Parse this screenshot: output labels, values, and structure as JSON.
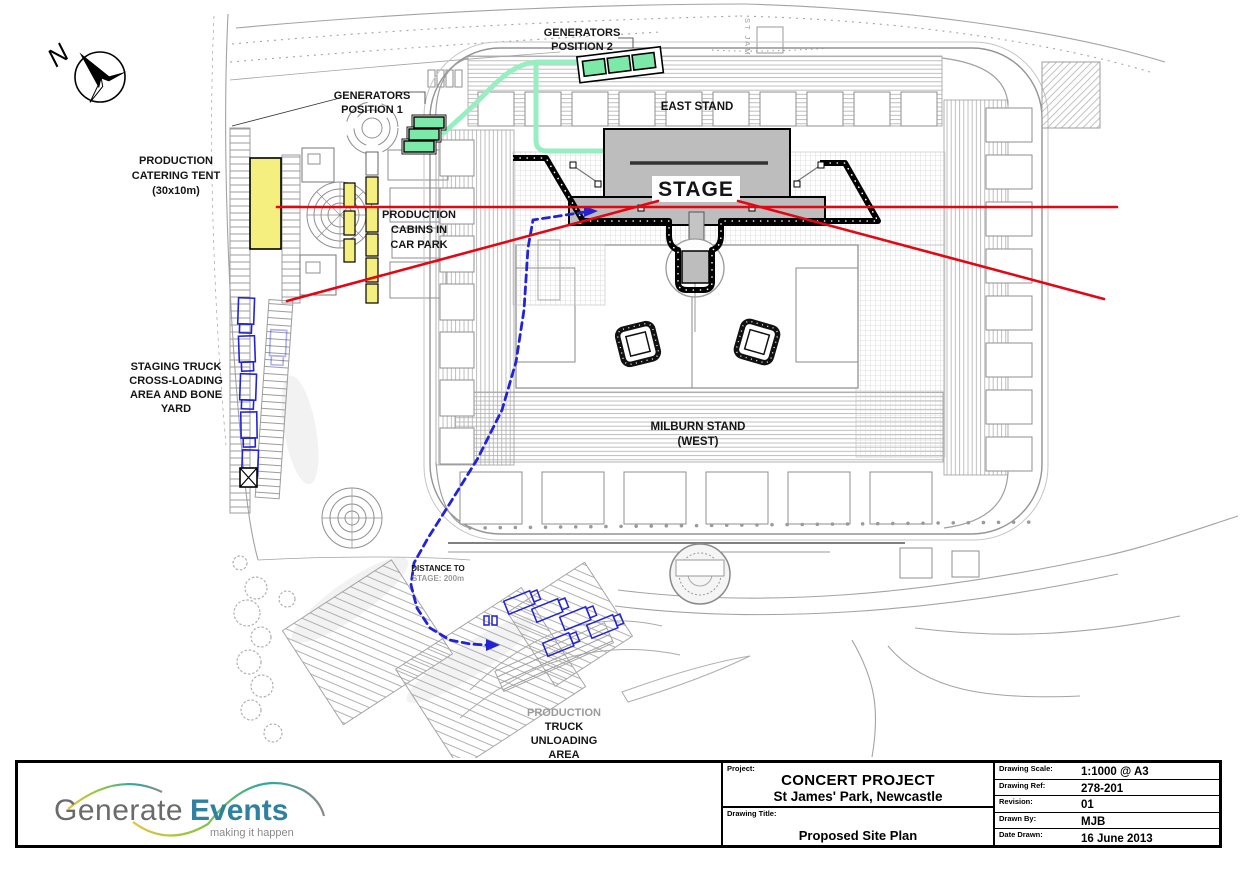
{
  "compass": {
    "north_label": "N"
  },
  "plan_labels": {
    "street_name": "ST JAM",
    "generators_position_2": [
      "GENERATORS",
      "POSITION 2"
    ],
    "generators_position_1": [
      "GENERATORS",
      "POSITION 1"
    ],
    "production_catering_tent": [
      "PRODUCTION",
      "CATERING TENT",
      "(30x10m)"
    ],
    "production_cabins": [
      "PRODUCTION",
      "CABINS IN",
      "CAR PARK"
    ],
    "east_stand": "EAST STAND",
    "stage": "STAGE",
    "milburn_stand": [
      "MILBURN STAND",
      "(WEST)"
    ],
    "staging_truck_yard": [
      "STAGING TRUCK",
      "CROSS-LOADING",
      "AREA AND BONE",
      "YARD"
    ],
    "distance_to_stage": [
      "DISTANCE TO",
      "STAGE: 200m"
    ],
    "production_truck_unloading": [
      "PRODUCTION",
      "TRUCK",
      "UNLOADING",
      "AREA"
    ]
  },
  "legend_colors": {
    "generator_green": "#7de9a8",
    "cable_route_green": "#97eec0",
    "tent_yellow": "#f4ef7e",
    "sightline_red": "#e30613",
    "truck_route_blue": "#2323d6",
    "stage_gray": "#bdbdbd"
  },
  "logo": {
    "word1": "Generate",
    "word2": "Events",
    "tagline": "making it happen"
  },
  "title_block": {
    "project_label": "Project:",
    "project_name": "CONCERT PROJECT",
    "project_location": "St James' Park, Newcastle",
    "drawing_title_label": "Drawing Title:",
    "drawing_title": "Proposed Site Plan",
    "fields": [
      {
        "label": "Drawing Scale:",
        "value": "1:1000 @ A3"
      },
      {
        "label": "Drawing Ref:",
        "value": "278-201"
      },
      {
        "label": "Revision:",
        "value": "01"
      },
      {
        "label": "Drawn By:",
        "value": "MJB"
      },
      {
        "label": "Date Drawn:",
        "value": "16 June 2013"
      }
    ]
  }
}
